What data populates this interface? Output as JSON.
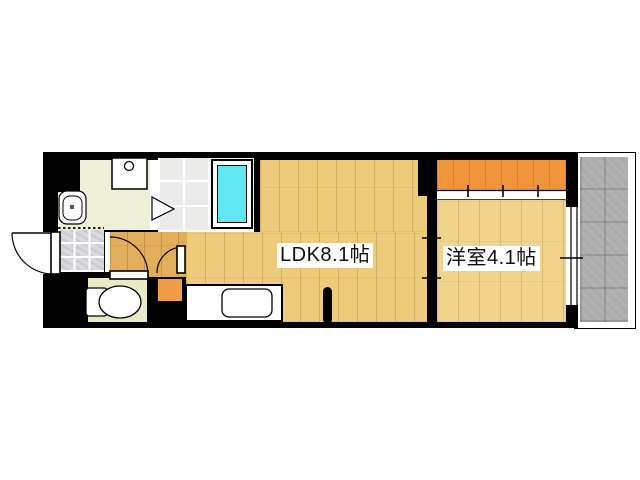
{
  "floorplan": {
    "labels": {
      "ldk": "LDK8.1帖",
      "western_room": "洋室4.1帖"
    },
    "colors": {
      "background": "#FFFFFF",
      "wall": "#000000",
      "wood_ldk": "#EECB7B",
      "wood_hall": "#E2AE5C",
      "wood_bedroom": "#F0D48C",
      "closet": "#F0953C",
      "cabinet": "#F29C47",
      "washroom_floor": "#EFEFD8",
      "toilet_floor": "#E9E9C6",
      "bath_floor": "#EBEBE9",
      "entrance_tile": "#DADADE",
      "balcony": "#ADADAD",
      "bathtub": "#5FE8F2"
    },
    "fixtures": [
      "bathtub",
      "washing-machine-pan",
      "wash-basin",
      "toilet",
      "kitchen-sink",
      "entrance-door",
      "bath-folding-door",
      "toilet-door",
      "washroom-door",
      "closet-sliding-door",
      "room-partition-sliding-door",
      "balcony-window"
    ]
  }
}
